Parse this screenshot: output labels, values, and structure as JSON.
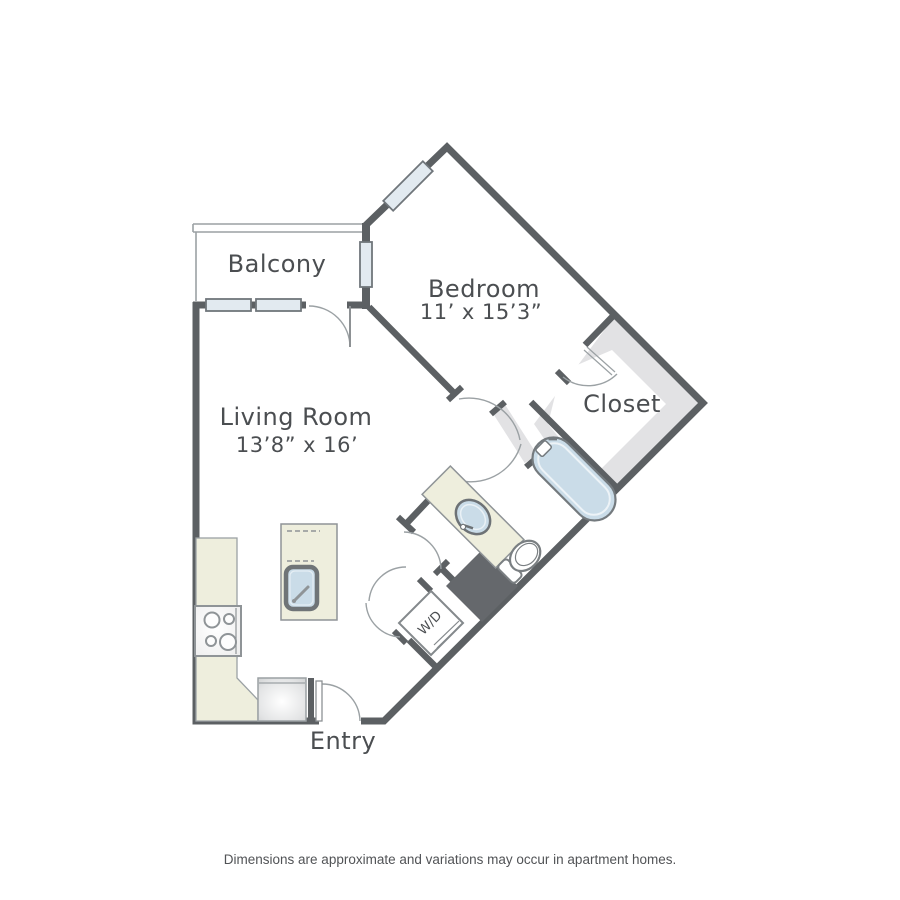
{
  "rooms": {
    "balcony": {
      "label": "Balcony"
    },
    "bedroom": {
      "label": "Bedroom",
      "dimensions": "11’ x 15’3”"
    },
    "living_room": {
      "label": "Living Room",
      "dimensions": "13’8” x 16’"
    },
    "closet": {
      "label": "Closet"
    },
    "entry": {
      "label": "Entry"
    },
    "laundry": {
      "label": "W/D"
    }
  },
  "footer": {
    "disclaimer": "Dimensions are approximate and variations may occur in apartment homes."
  },
  "colors": {
    "wall": "#5c6063",
    "thin_line": "#9ba1a4",
    "window_fill": "#e2eaf0",
    "window_border": "#70767b",
    "closet_shading": "#e2e2e4",
    "counter_beige": "#eeeedd",
    "fixture_blue": "#cadce8",
    "dark_block": "#65686c",
    "label_text": "#4b4e51"
  }
}
